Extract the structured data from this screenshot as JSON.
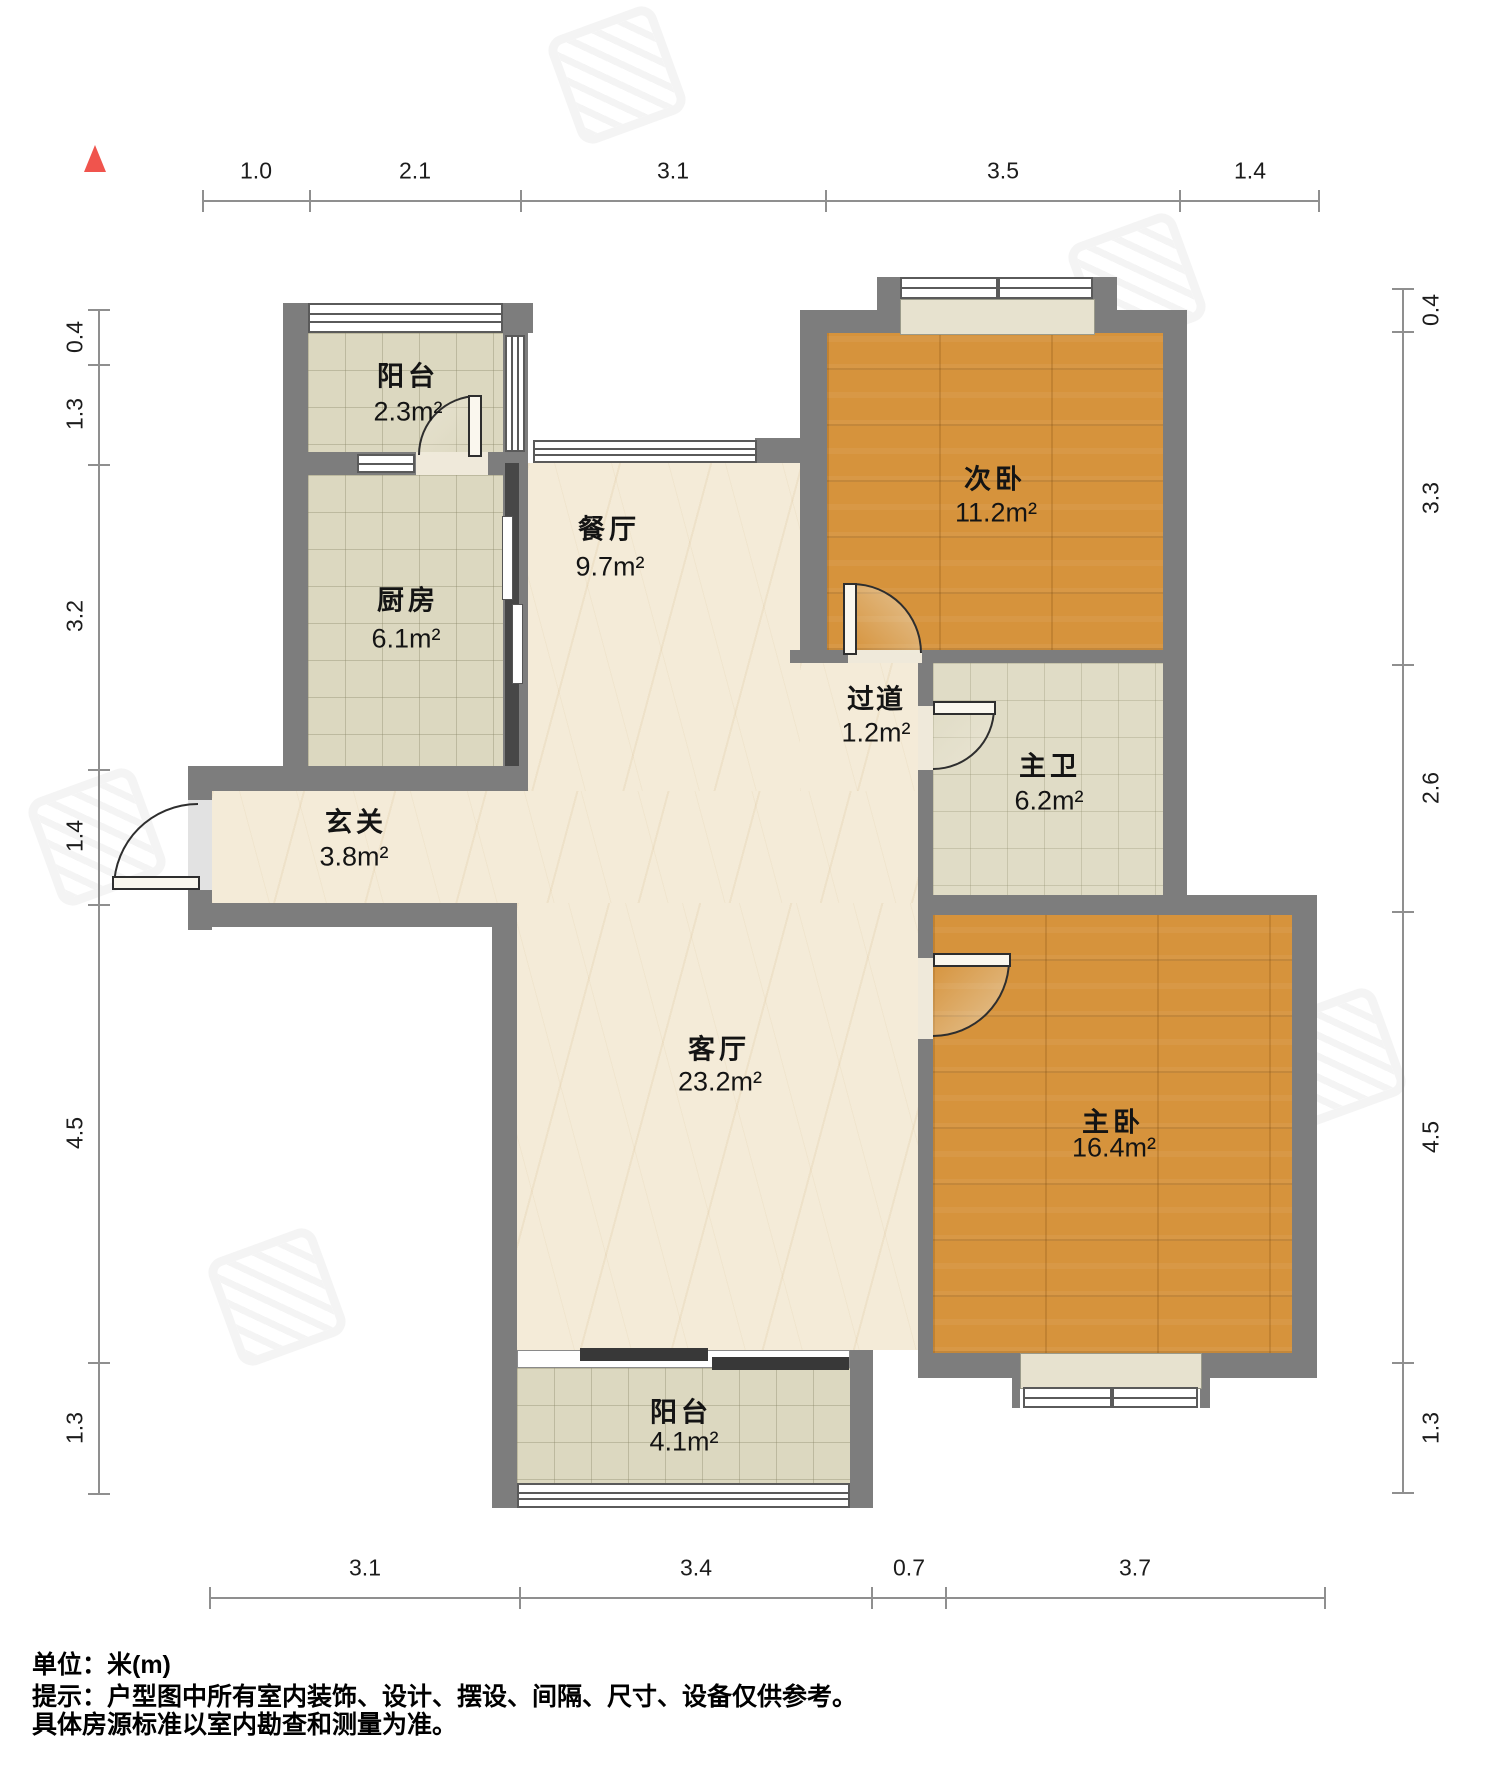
{
  "title": "户型图",
  "unit_system": "米(m)",
  "north_indicator": "north-arrow-icon",
  "colors": {
    "wall": "#7d7d7d",
    "wood_floor": "#d6933c",
    "tile_floor": "#dcd8c0",
    "marble_floor": "#f4ebd8",
    "north_arrow": "#f0544d",
    "dimension_line": "#8f8f8f",
    "sliding_door_panel": "#383838"
  },
  "rooms": [
    {
      "id": "balcony-top",
      "name": "阳台",
      "area": "2.3m²"
    },
    {
      "id": "kitchen",
      "name": "厨房",
      "area": "6.1m²"
    },
    {
      "id": "dining-room",
      "name": "餐厅",
      "area": "9.7m²"
    },
    {
      "id": "second-bedroom",
      "name": "次卧",
      "area": "11.2m²"
    },
    {
      "id": "hallway",
      "name": "过道",
      "area": "1.2m²"
    },
    {
      "id": "master-bathroom",
      "name": "主卫",
      "area": "6.2m²"
    },
    {
      "id": "entrance",
      "name": "玄关",
      "area": "3.8m²"
    },
    {
      "id": "living-room",
      "name": "客厅",
      "area": "23.2m²"
    },
    {
      "id": "master-bedroom",
      "name": "主卧",
      "area": "16.4m²"
    },
    {
      "id": "balcony-bottom",
      "name": "阳台",
      "area": "4.1m²"
    }
  ],
  "dimensions": {
    "top": [
      "1.0",
      "2.1",
      "3.1",
      "3.5",
      "1.4"
    ],
    "bottom": [
      "3.1",
      "3.4",
      "0.7",
      "3.7"
    ],
    "left": [
      "0.4",
      "1.3",
      "3.2",
      "1.4",
      "4.5",
      "1.3"
    ],
    "right": [
      "0.4",
      "3.3",
      "2.6",
      "4.5",
      "1.3"
    ]
  },
  "footer": {
    "unit": "单位：米(m)",
    "tip": "提示：户型图中所有室内装饰、设计、摆设、间隔、尺寸、设备仅供参考。",
    "note": "具体房源标准以室内勘查和测量为准。"
  }
}
